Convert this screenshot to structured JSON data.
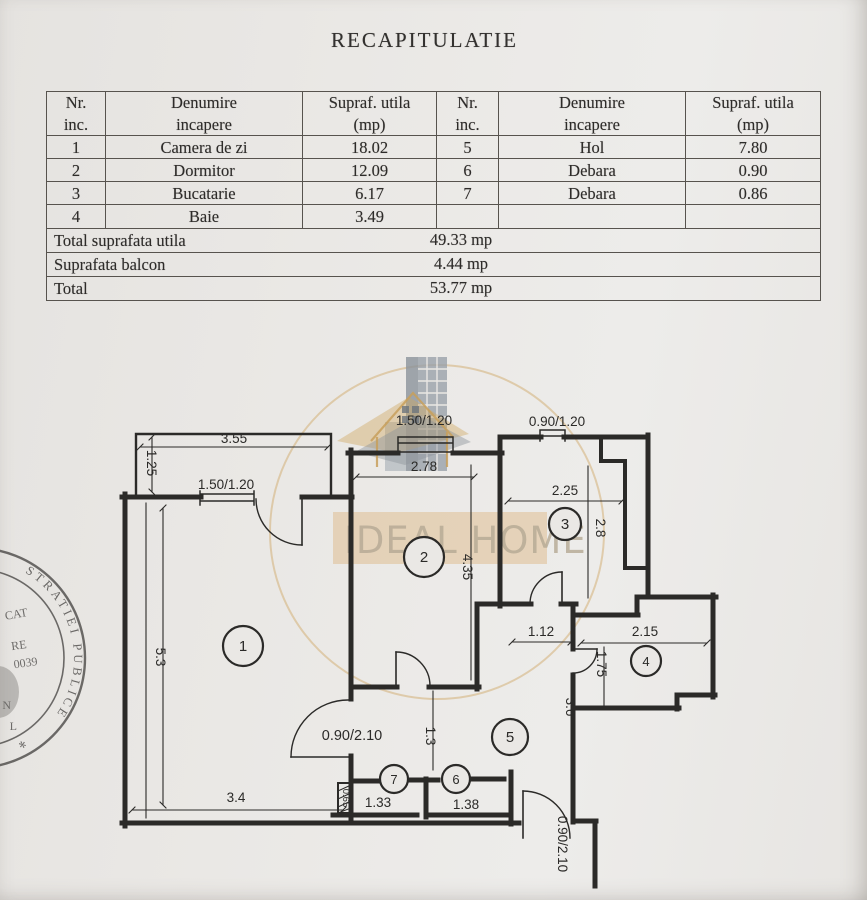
{
  "title": "RECAPITULATIE",
  "table": {
    "headers": {
      "nr": "Nr.",
      "inc": "inc.",
      "denumire": "Denumire",
      "incapere": "incapere",
      "supraf": "Supraf. utila",
      "mp": "(mp)"
    },
    "rows": [
      [
        "1",
        "Camera de zi",
        "18.02",
        "5",
        "Hol",
        "7.80"
      ],
      [
        "2",
        "Dormitor",
        "12.09",
        "6",
        "Debara",
        "0.90"
      ],
      [
        "3",
        "Bucatarie",
        "6.17",
        "7",
        "Debara",
        "0.86"
      ],
      [
        "4",
        "Baie",
        "3.49",
        "",
        "",
        ""
      ]
    ],
    "totals": [
      {
        "label": "Total suprafata utila",
        "value": "49.33 mp"
      },
      {
        "label": "Suprafata balcon",
        "value": "4.44 mp"
      },
      {
        "label": "Total",
        "value": "53.77 mp"
      }
    ]
  },
  "plan": {
    "rooms": {
      "r1": "1",
      "r2": "2",
      "r3": "3",
      "r4": "4",
      "r5": "5",
      "r6": "6",
      "r7": "7"
    },
    "dims": {
      "balcony_w": "3.55",
      "balcony_d": "1.25",
      "win1": "1.50/1.20",
      "win2": "1.50/1.20",
      "win3": "0.90/1.20",
      "room2_w": "2.78",
      "room2_h": "4.35",
      "room3_w": "2.25",
      "room3_h": "2.8",
      "pass": "1.12",
      "room4_w": "2.15",
      "room4_h": "1.75",
      "dim36": "3.6",
      "room1_h": "5.3",
      "room1_w": "3.4",
      "door1": "0.90/2.10",
      "dim13": "1.3",
      "room7_w": "1.33",
      "room6_w": "1.38",
      "shaft": "0.65",
      "entry": "0.90/2.10"
    }
  },
  "watermark": {
    "brand": "IDEAL HOME"
  },
  "stamp": {
    "arc_text": "STRATIEI PUBLICE",
    "line1": "CAT",
    "line2": "RE",
    "line3": "0039",
    "line4": "N",
    "line5": "L",
    "star": "*"
  },
  "colors": {
    "paper": "#e9e7e4",
    "ink": "#2e2c2a",
    "walls": "#2b2a28",
    "gold_ring": "#cfa45f",
    "watermark_band": "#ddb98a",
    "building_gray": "#99a1a9",
    "stamp_ink": "#4c4a48"
  }
}
